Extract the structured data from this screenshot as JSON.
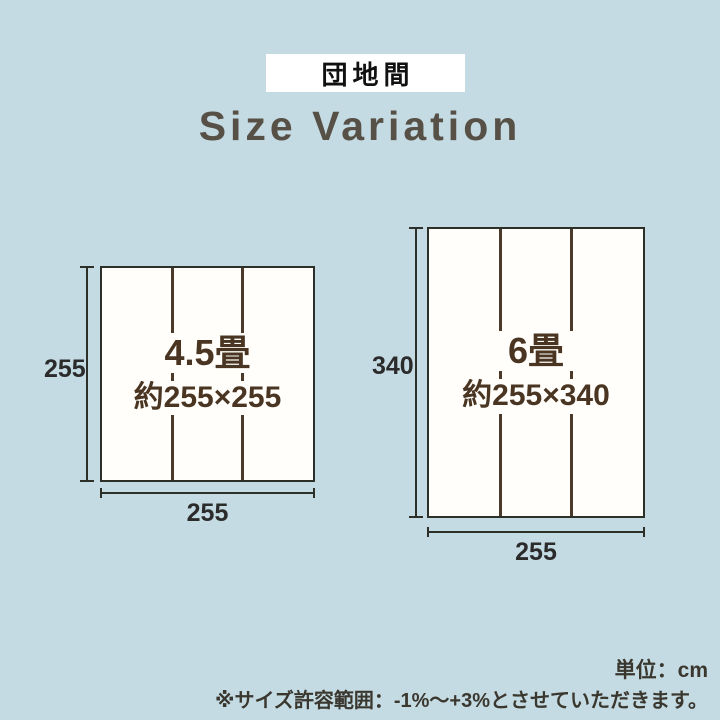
{
  "badge": {
    "label": "団地間"
  },
  "title": {
    "text": "Size Variation"
  },
  "diagrams": [
    {
      "name": "4.5-tatami",
      "size_label": "4.5畳",
      "approx_label": "約255×255",
      "height_cm": "255",
      "width_cm": "255",
      "panel_count": 3
    },
    {
      "name": "6-tatami",
      "size_label": "6畳",
      "approx_label": "約255×340",
      "height_cm": "340",
      "width_cm": "255",
      "panel_count": 3
    }
  ],
  "notes": {
    "unit": "単位：cm",
    "tolerance": "※サイズ許容範囲：-1%〜+3%とさせていただきます。"
  },
  "colors": {
    "background": "#c4dbe3",
    "panel": "#fffefa",
    "outline": "#2d2f29",
    "tatami_divider": "#4b3a2a",
    "label_brown": "#4a3522",
    "title_gray": "#575047",
    "note_gray": "#3a372f",
    "badge_bg": "#ffffff",
    "badge_text": "#111111"
  }
}
